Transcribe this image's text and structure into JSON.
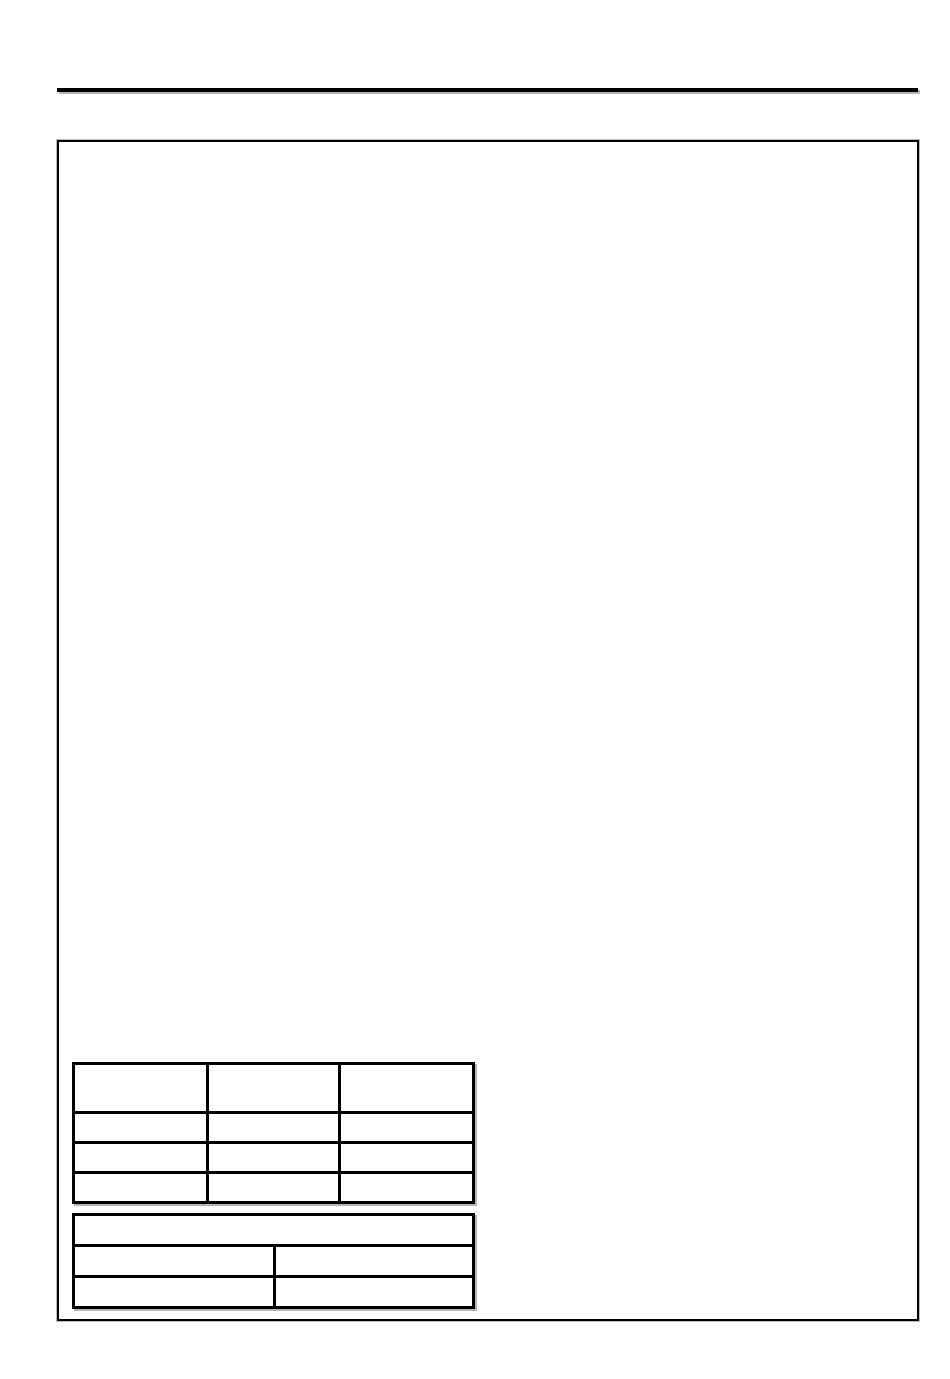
{
  "page": {
    "background": "#ffffff",
    "rule_color": "#000000",
    "border_color": "#000000",
    "shadow_color": "#b4b4b4"
  },
  "content_frame": {
    "text": ""
  },
  "upper_table": {
    "rows": [
      [
        "",
        "",
        ""
      ],
      [
        "",
        "",
        ""
      ],
      [
        "",
        "",
        ""
      ],
      [
        "",
        "",
        ""
      ]
    ]
  },
  "lower_table": {
    "header_cell": "",
    "rows": [
      [
        "",
        ""
      ],
      [
        "",
        ""
      ]
    ]
  }
}
